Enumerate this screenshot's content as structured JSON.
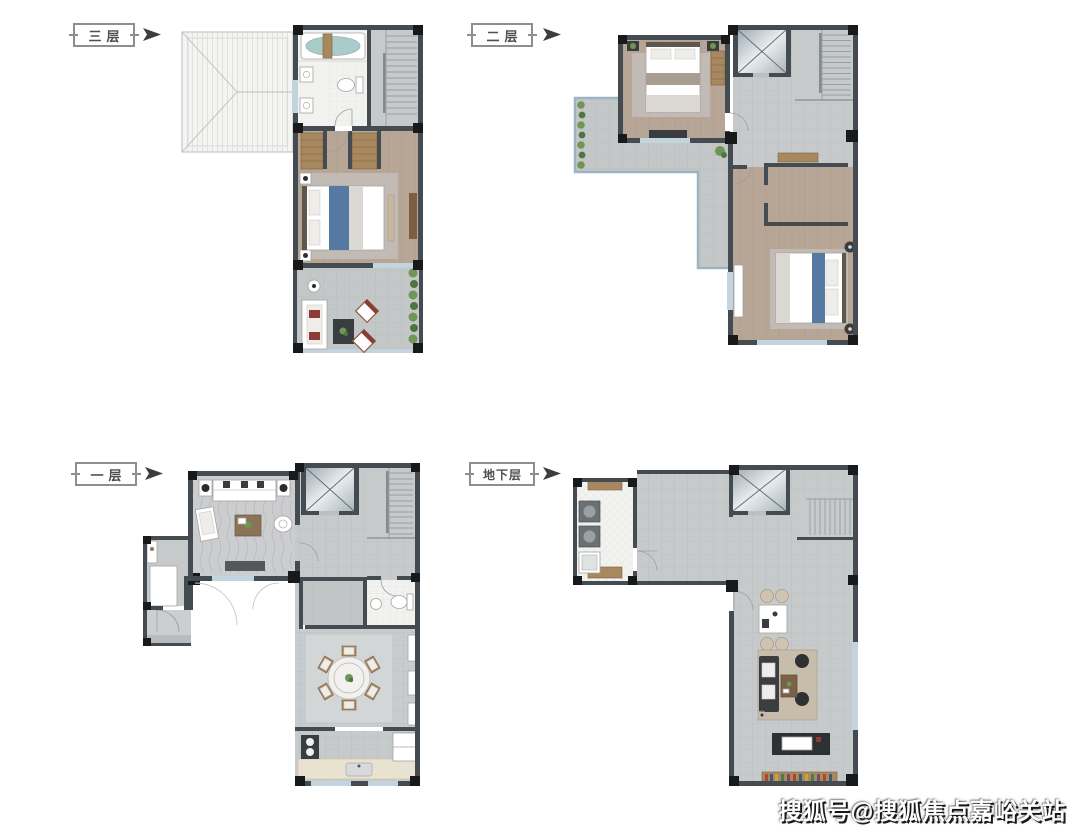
{
  "sheet": {
    "background": "#ffffff"
  },
  "plans": [
    {
      "id": "floor-3",
      "label": "三层",
      "rooms": [
        "roof",
        "bathroom",
        "staircase",
        "bedroom",
        "terrace"
      ]
    },
    {
      "id": "floor-2",
      "label": "二层",
      "rooms": [
        "terrace",
        "bedroom",
        "elevator",
        "staircase",
        "hall",
        "bathroom",
        "bedroom-2"
      ]
    },
    {
      "id": "floor-1",
      "label": "一层",
      "rooms": [
        "living-room",
        "elevator",
        "staircase",
        "entry-porch",
        "courtyard",
        "bathroom",
        "dining-room",
        "kitchen"
      ]
    },
    {
      "id": "basement",
      "label": "地下层",
      "rooms": [
        "laundry-room",
        "elevator",
        "staircase",
        "hall",
        "family-room"
      ]
    }
  ],
  "watermark": {
    "text": "搜狐号@搜狐焦点嘉峪关站",
    "color": "#ffffff",
    "shadow": "#000000"
  },
  "colors": {
    "wall": "#454c51",
    "corner": "#17191b",
    "tile": "#c7cacb",
    "terrace": "#c3c7c8",
    "wood": "#b7a596",
    "wood-furn": "#a8885f",
    "wood-furn-dark": "#7c5f3f",
    "bath-floor": "#f2f2f0",
    "bath-water": "#a9cbc9",
    "glass": "#c3d4df",
    "glass-frame": "#9db3c2",
    "roof": "#f4f4f3",
    "accent": "#5679a1",
    "dark-furn": "#3a3d3f",
    "rug": "#cdd0d1",
    "plant": "#6f9655",
    "plant-dark": "#4f7440",
    "cushion-red": "#8d3b34",
    "counter": "#eae2d0",
    "stair-line": "#989ea1",
    "wm": "#ffffff"
  }
}
